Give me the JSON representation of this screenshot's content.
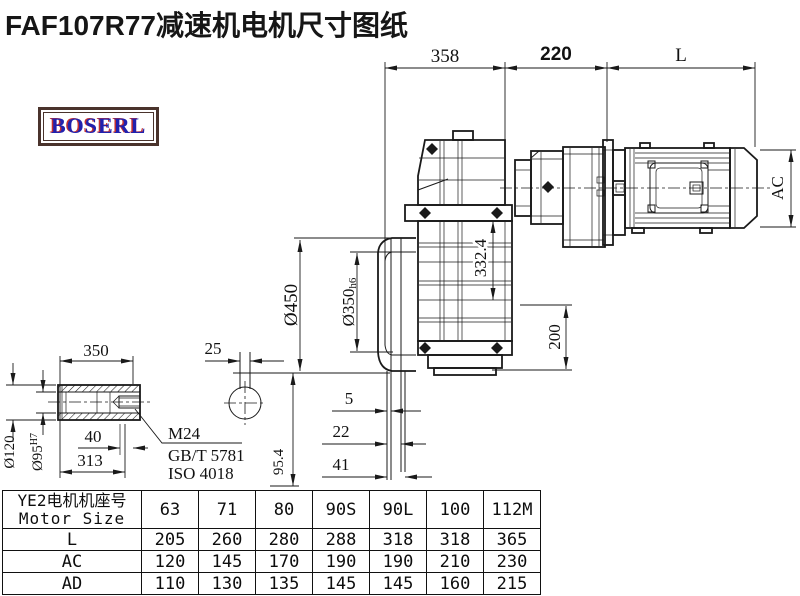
{
  "title": "FAF107R77减速机电机尺寸图纸",
  "logo": {
    "text": "BOSERL"
  },
  "colors": {
    "line": "#1a1a1a",
    "logo_text_blue": "#2121ae",
    "logo_shadow_red": "#c53030",
    "logo_border_brown": "#4a332c"
  },
  "drawing": {
    "dims": {
      "top_left": "358",
      "top_mid": "220",
      "top_right": "L",
      "motor_height": "AC",
      "flange_od": "Ø450",
      "spigot_main": "Ø350",
      "spigot_tol": "h6",
      "axis_height": "332.4",
      "side_height": "200",
      "offset_a": "5",
      "offset_b": "22",
      "offset_c": "41"
    },
    "shaft_detail": {
      "length": "350",
      "hub_od": "Ø120",
      "bore_main": "Ø95",
      "bore_tol": "H7",
      "depth": "40",
      "length2": "313",
      "thread": "M24",
      "standard1": "GB/T 5781",
      "standard2": "ISO 4018",
      "section_width": "25",
      "section_height": "95.4"
    }
  },
  "table": {
    "header_cn": "YE2电机机座号",
    "header_en": "Motor Size",
    "sizes": [
      "63",
      "71",
      "80",
      "90S",
      "90L",
      "100",
      "112M"
    ],
    "rows": [
      {
        "label": "L",
        "values": [
          "205",
          "260",
          "280",
          "288",
          "318",
          "318",
          "365"
        ]
      },
      {
        "label": "AC",
        "values": [
          "120",
          "145",
          "170",
          "190",
          "190",
          "210",
          "230"
        ]
      },
      {
        "label": "AD",
        "values": [
          "110",
          "130",
          "135",
          "145",
          "145",
          "160",
          "215"
        ]
      }
    ]
  }
}
